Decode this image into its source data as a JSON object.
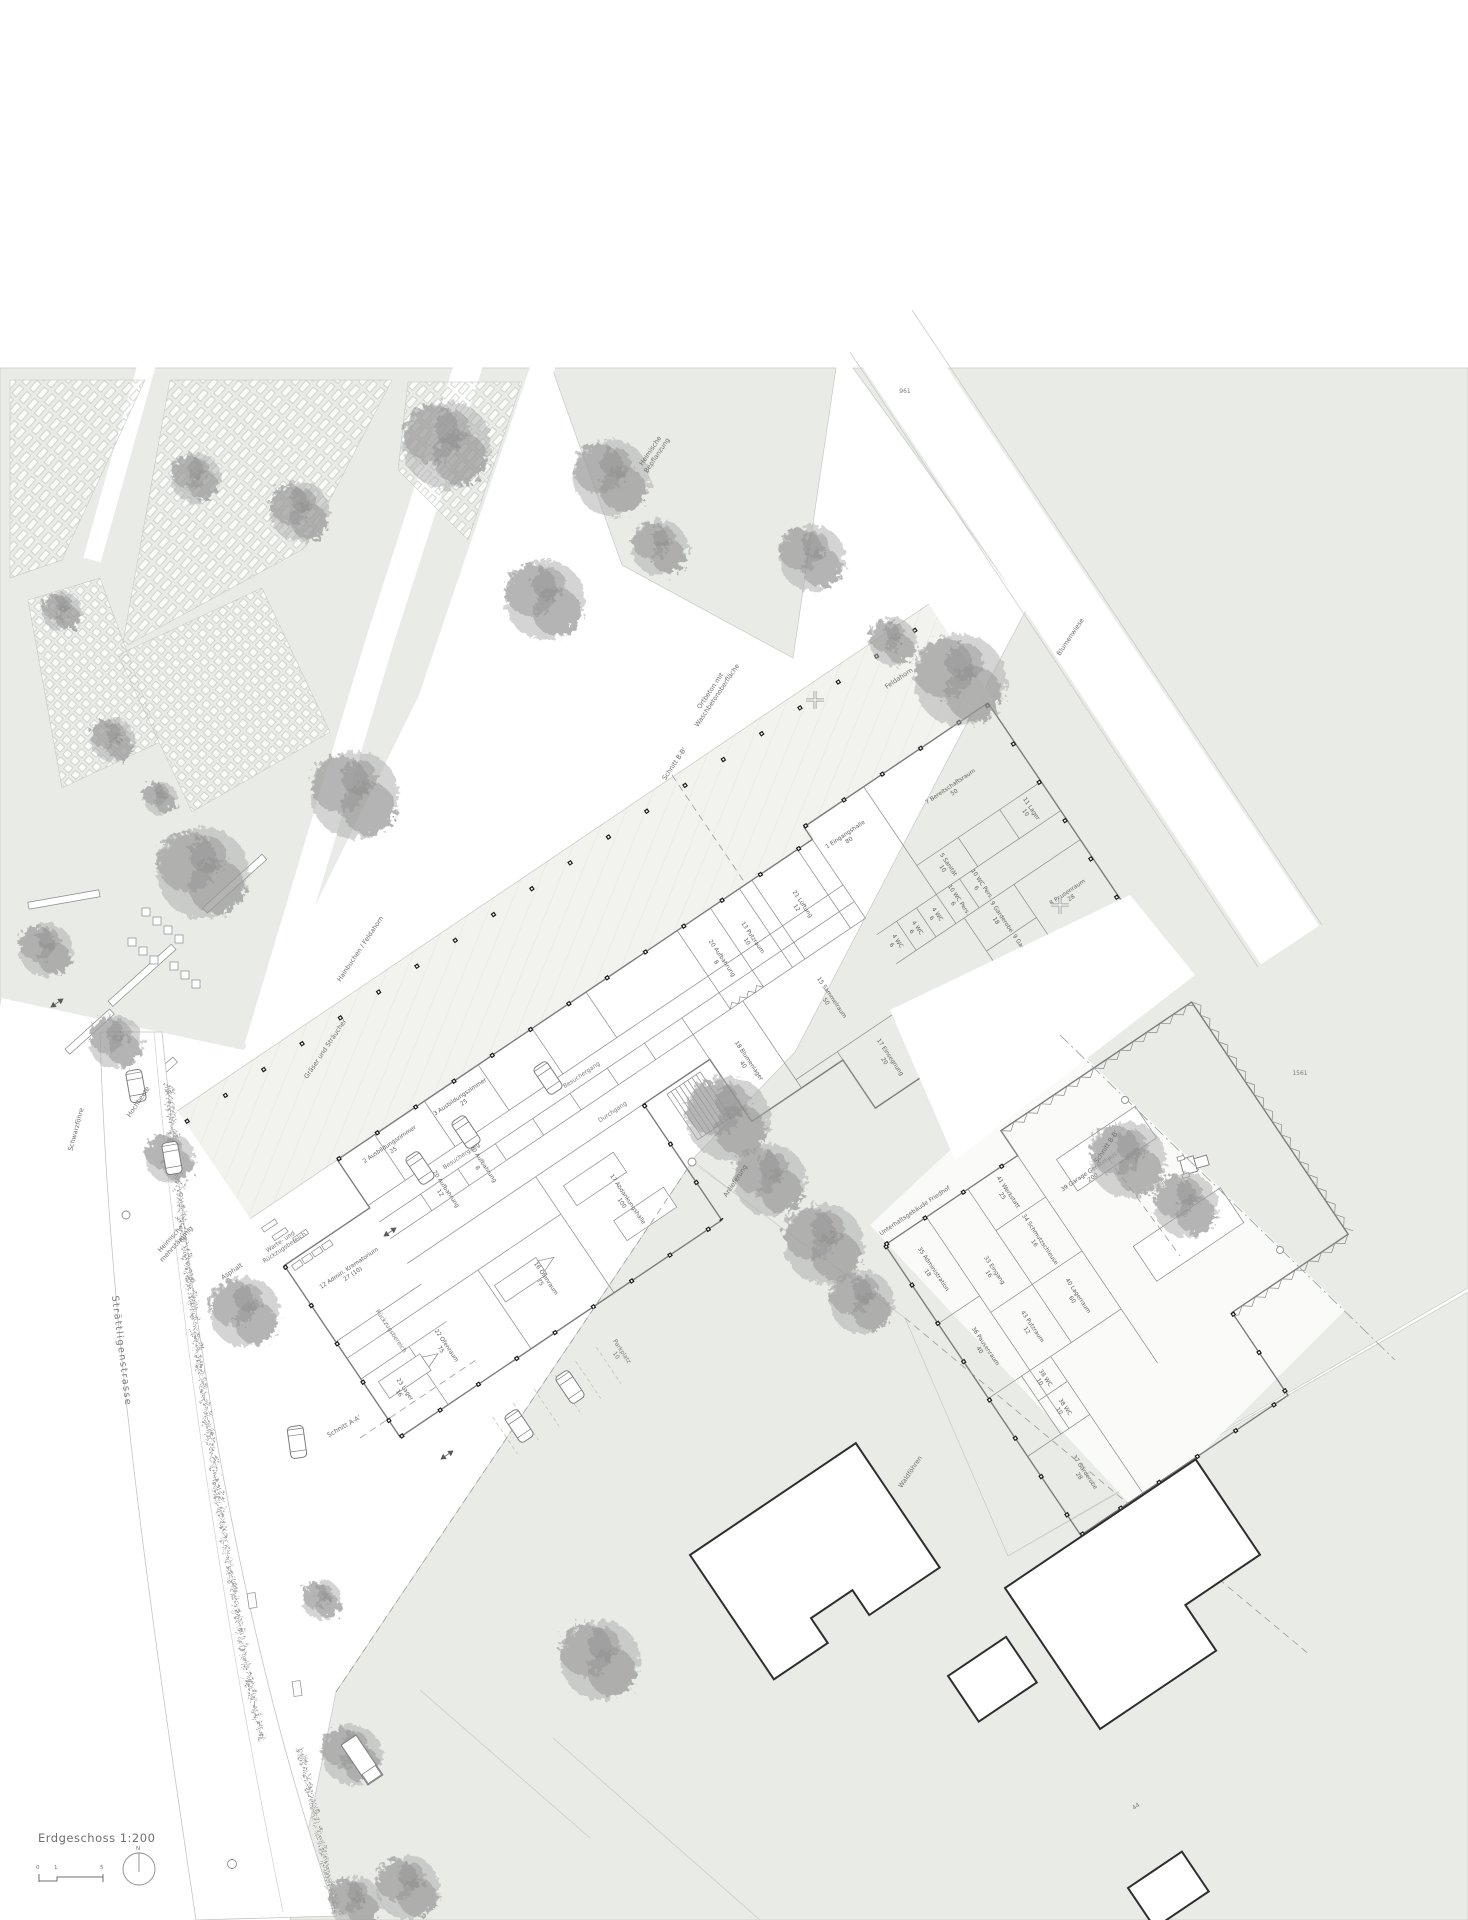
{
  "title_block": {
    "title": "Erdgeschoss  1:200",
    "tick0": "0",
    "tick1": "1",
    "tick5": "5",
    "north": "N"
  },
  "streets": {
    "main": "Strättligenstrasse"
  },
  "sections": {
    "a": "Schnitt A-A'",
    "b_top": "Schnitt B-B'",
    "b_right": "Schnitt B-B'"
  },
  "site": {
    "ortbeton_l1": "Ortbeton mit",
    "ortbeton_l2": "Waschbetonoberfläche",
    "asphalt": "Asphalt",
    "parkplatz_l1": "Parkplatz",
    "parkplatz_l2": "10",
    "anlieferung": "Anlieferung",
    "hochbeete": "Hochbeete",
    "warte_l1": "Warte- und",
    "warte_l2": "Rückzugsbereich",
    "rueckzugsbereich": "Rückzugsbereich",
    "parcel_a": "961",
    "parcel_b": "1561",
    "house_no": "44"
  },
  "planting": {
    "hainbuchen": "Hainbuchen / Feldahorn",
    "graeser": "Gräser und Sträucher",
    "schwarzfoehre": "Schwarzföhre",
    "waldfoehren": "Waldföhren",
    "feldahorn": "Feldahorn",
    "blumenwiese": "Blumenwiese",
    "heimische_a_l1": "Heimische",
    "heimische_a_l2": "Bepflanzung",
    "heimische_b_l1": "Heimische",
    "heimische_b_l2": "mehrstämmig"
  },
  "main_building": {
    "circulation": {
      "besuchergang_a": "Besuchergang",
      "besuchergang_b": "Besuchergang",
      "durchgang": "Durchgang"
    },
    "rooms": [
      {
        "l1": "1 Eingangshalle",
        "l2": "80"
      },
      {
        "l1": "7 Bereitschaftsraum",
        "l2": "50"
      },
      {
        "l1": "5 Sanität",
        "l2": "10"
      },
      {
        "l1": "11 Lager",
        "l2": "10"
      },
      {
        "l1": "10 WC Pers.",
        "l2": "6"
      },
      {
        "l1": "10 WC Pers.",
        "l2": "6"
      },
      {
        "l1": "9 Garderobe",
        "l2": "18"
      },
      {
        "l1": "9 Garderobe",
        "l2": "18"
      },
      {
        "l1": "4 WC",
        "l2": "6"
      },
      {
        "l1": "4 WC",
        "l2": "6"
      },
      {
        "l1": "4 WC",
        "l2": "6"
      },
      {
        "l1": "8 Pausenraum",
        "l2": "28"
      },
      {
        "l1": "21 Lüftung",
        "l2": "12"
      },
      {
        "l1": "13 Putzraum",
        "l2": "10"
      },
      {
        "l1": "2 Ausbildungszimmer",
        "l2": "25"
      },
      {
        "l1": "3 Ausbildungszimmer",
        "l2": "25"
      },
      {
        "l1": "20 Aufbahrung",
        "l2": "12"
      },
      {
        "l1": "20 Aufbahrung",
        "l2": "8"
      },
      {
        "l1": "20 Aufbahrung",
        "l2": "8"
      },
      {
        "l1": "15 Sammelraum",
        "l2": "50"
      },
      {
        "l1": "18 Blumenlager",
        "l2": "40"
      },
      {
        "l1": "17 Einsegnung",
        "l2": "20"
      },
      {
        "l1": "14 Ankunft Verabschiedung",
        "l2": "50"
      },
      {
        "l1": "16 Ofenraum",
        "l2": "75"
      },
      {
        "l1": "22 Ofenraum",
        "l2": "75"
      },
      {
        "l1": "12 Admin. Krematorium",
        "l2": "27 (10)"
      },
      {
        "l1": "23 Lager",
        "l2": "16"
      },
      {
        "l1": "17 Abdankungshalle",
        "l2": "100"
      }
    ]
  },
  "maintenance_building": {
    "name": "Unterhaltsgebäude Friedhof",
    "rooms": [
      {
        "l1": "35 Administration",
        "l2": "18"
      },
      {
        "l1": "33 Eingang",
        "l2": "16"
      },
      {
        "l1": "41 Werkstatt",
        "l2": "25"
      },
      {
        "l1": "34 Schmutzschleuse",
        "l2": "16"
      },
      {
        "l1": "40 Lagerraum",
        "l2": "60"
      },
      {
        "l1": "43 Putzraum",
        "l2": "12"
      },
      {
        "l1": "38 WC",
        "l2": "10"
      },
      {
        "l1": "38 WC",
        "l2": "10"
      },
      {
        "l1": "37 Garderobe",
        "l2": "28"
      },
      {
        "l1": "36 Pausenraum",
        "l2": "40"
      },
      {
        "l1": "39 Garage Gerätehaus",
        "l2": "200"
      }
    ]
  }
}
